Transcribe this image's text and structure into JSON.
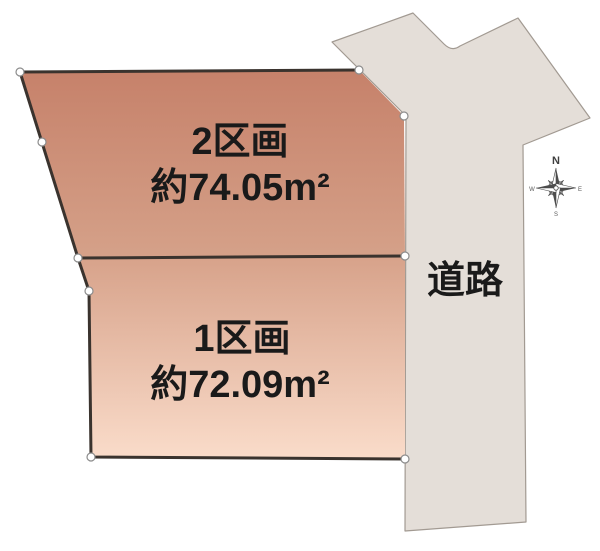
{
  "diagram": {
    "kind": "land-plot-layout",
    "background": "#ffffff"
  },
  "parcels": [
    {
      "label": "2区画",
      "area": "約74.05m²",
      "fill_top": "#c6816a",
      "fill_bottom": "#d5a189"
    },
    {
      "label": "1区画",
      "area": "約72.09m²",
      "fill_top": "#d7a28a",
      "fill_bottom": "#fadcca"
    }
  ],
  "road": {
    "label": "道路",
    "fill": "#e4ded8",
    "border": "#a29a92"
  },
  "boundary": {
    "line_color": "#3a332e",
    "vertex_fill": "#ffffff",
    "vertex_stroke": "#8c8c8c"
  },
  "compass": {
    "north": "N",
    "east": "E",
    "south": "S",
    "west": "W",
    "color": "#4d4d4d"
  },
  "text_color": "#1a1a1a"
}
